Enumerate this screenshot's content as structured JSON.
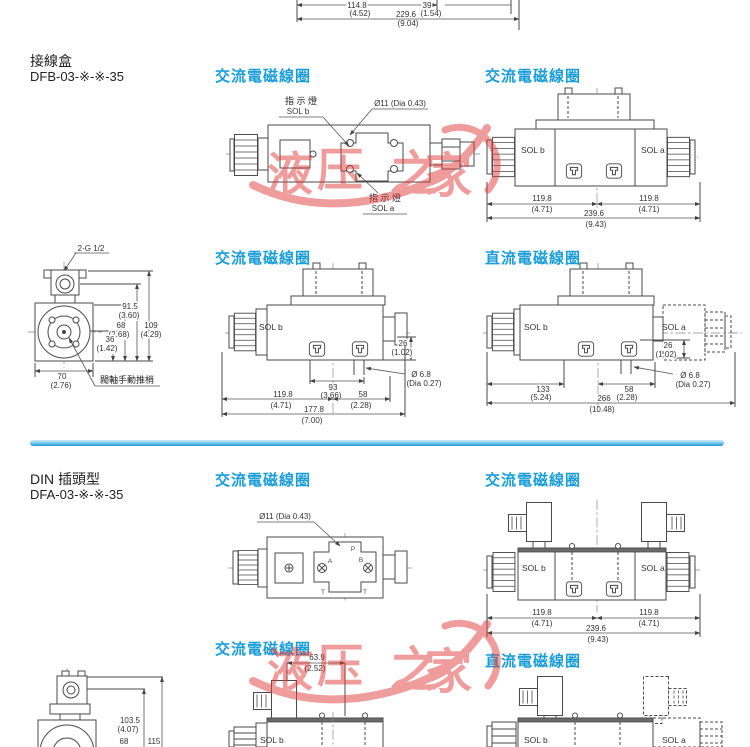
{
  "labels": {
    "ac": "交流電磁線圈",
    "dc": "直流電磁線圈",
    "sol_a": "SOL a",
    "sol_b": "SOL b",
    "indicator": "指 示 燈",
    "t": "T"
  },
  "sections": {
    "s1": {
      "title": "接線盒",
      "model": "DFB-03-※-※-35"
    },
    "s2": {
      "title": "DIN 插頭型",
      "model": "DFA-03-※-※-35"
    }
  },
  "top_dims": {
    "d1": "114.8",
    "d1i": "(4.52)",
    "d2": "39",
    "d2i": "(1.54)",
    "d3": "229.6",
    "d3i": "(9.04)"
  },
  "watermark": {
    "chars": [
      "液",
      "压",
      "之",
      "家"
    ]
  },
  "drawings": {
    "a": {
      "dia": "Ø11 (Dia 0.43)"
    },
    "b": {
      "d1": "119.8",
      "d1i": "(4.71)",
      "d2": "119.8",
      "d2i": "(4.71)",
      "d3": "239.6",
      "d3i": "(9.43)"
    },
    "c": {
      "port": "2-G 1/2",
      "d1": "91.5",
      "d1i": "(3.60)",
      "d2": "68",
      "d2i": "(2.68)",
      "d3": "36",
      "d3i": "(1.42)",
      "d4": "109",
      "d4i": "(4.29)",
      "d5": "70",
      "d5i": "(2.76)",
      "label": "閥軸手動推梢"
    },
    "d": {
      "d1": "26",
      "d1i": "(1.02)",
      "d2": "Ø 6.8",
      "d2i": "(Dia 0.27)",
      "d3": "93",
      "d3i": "(3.66)",
      "d4": "119.8",
      "d4i": "(4.71)",
      "d5": "58",
      "d5i": "(2.28)",
      "d6": "177.8",
      "d6i": "(7.00)"
    },
    "e": {
      "d1": "26",
      "d1i": "(1.02)",
      "d2": "Ø 6.8",
      "d2i": "(Dia 0.27)",
      "d3": "133",
      "d3i": "(5.24)",
      "d4": "58",
      "d4i": "(2.28)",
      "d5": "266",
      "d5i": "(10.48)"
    },
    "f": {
      "dia": "Ø11 (Dia 0.43)",
      "p": "P",
      "a": "A",
      "b": "B"
    },
    "g": {
      "d1": "119.8",
      "d1i": "(4.71)",
      "d2": "119.8",
      "d2i": "(4.71)",
      "d3": "239.6",
      "d3i": "(9.43)"
    },
    "h": {
      "d1": "63.9",
      "d1i": "(2.52)"
    },
    "j": {
      "d1": "103.5",
      "d1i": "(4.07)",
      "d2": "68",
      "d3": "115"
    }
  }
}
